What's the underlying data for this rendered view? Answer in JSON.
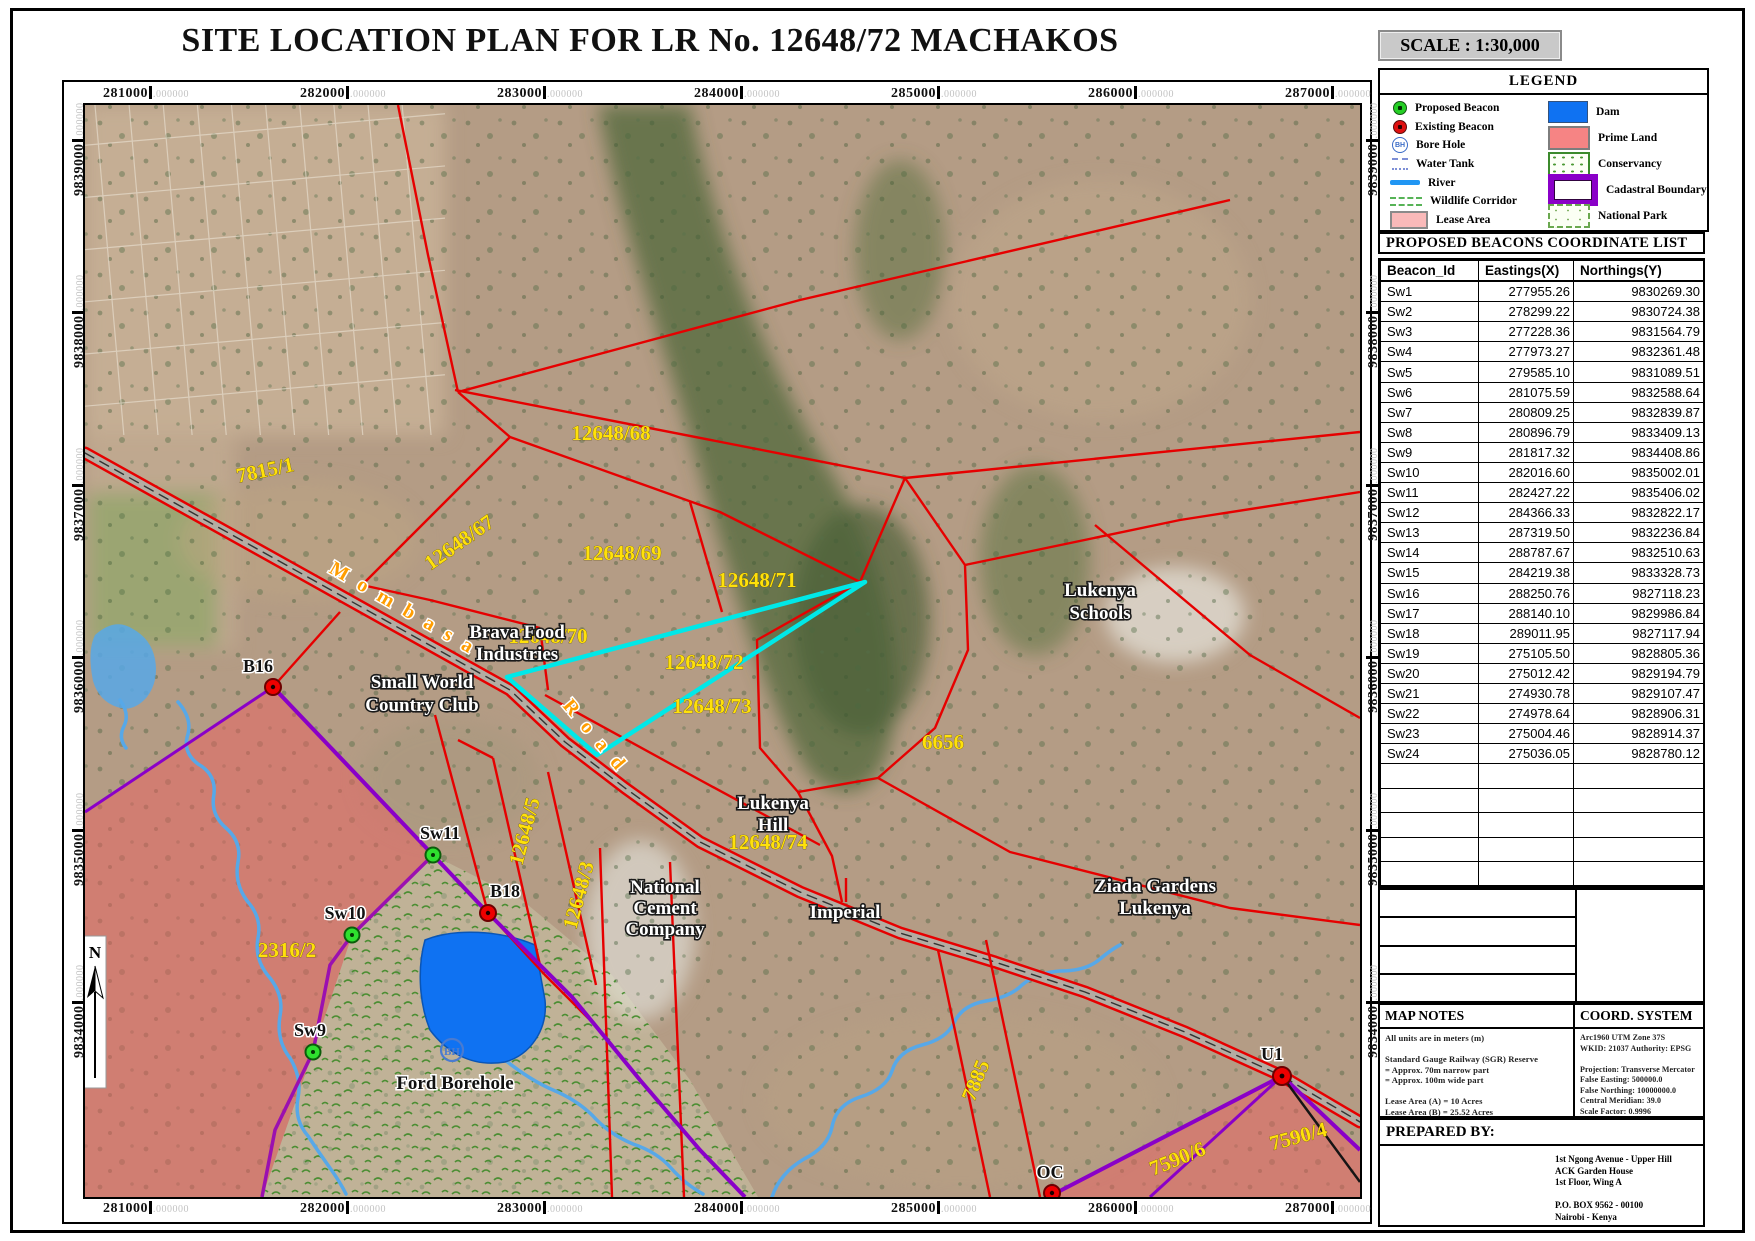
{
  "title": "SITE LOCATION PLAN FOR LR No. 12648/72 MACHAKOS",
  "scale_label": "SCALE : 1:30,000",
  "legend": {
    "title": "LEGEND",
    "items_left": [
      {
        "label": "Proposed Beacon"
      },
      {
        "label": "Existing Beacon"
      },
      {
        "label": "Bore Hole"
      },
      {
        "label": "Water Tank"
      },
      {
        "label": "River"
      },
      {
        "label": "Wildlife Corridor"
      },
      {
        "label": "Lease Area"
      }
    ],
    "items_right": [
      {
        "label": "Dam"
      },
      {
        "label": "Prime Land"
      },
      {
        "label": "Conservancy"
      },
      {
        "label": "Cadastral Boundary"
      },
      {
        "label": "National Park"
      }
    ]
  },
  "beacon_table": {
    "title": "PROPOSED BEACONS COORDINATE LIST",
    "columns": [
      "Beacon_Id",
      "Eastings(X)",
      "Northings(Y)"
    ],
    "rows": [
      {
        "id": "Sw1",
        "e": "277955.26",
        "n": "9830269.30"
      },
      {
        "id": "Sw2",
        "e": "278299.22",
        "n": "9830724.38"
      },
      {
        "id": "Sw3",
        "e": "277228.36",
        "n": "9831564.79"
      },
      {
        "id": "Sw4",
        "e": "277973.27",
        "n": "9832361.48"
      },
      {
        "id": "Sw5",
        "e": "279585.10",
        "n": "9831089.51"
      },
      {
        "id": "Sw6",
        "e": "281075.59",
        "n": "9832588.64"
      },
      {
        "id": "Sw7",
        "e": "280809.25",
        "n": "9832839.87"
      },
      {
        "id": "Sw8",
        "e": "280896.79",
        "n": "9833409.13"
      },
      {
        "id": "Sw9",
        "e": "281817.32",
        "n": "9834408.86"
      },
      {
        "id": "Sw10",
        "e": "282016.60",
        "n": "9835002.01"
      },
      {
        "id": "Sw11",
        "e": "282427.22",
        "n": "9835406.02"
      },
      {
        "id": "Sw12",
        "e": "284366.33",
        "n": "9832822.17"
      },
      {
        "id": "Sw13",
        "e": "287319.50",
        "n": "9832236.84"
      },
      {
        "id": "Sw14",
        "e": "288787.67",
        "n": "9832510.63"
      },
      {
        "id": "Sw15",
        "e": "284219.38",
        "n": "9833328.73"
      },
      {
        "id": "Sw16",
        "e": "288250.76",
        "n": "9827118.23"
      },
      {
        "id": "Sw17",
        "e": "288140.10",
        "n": "9829986.84"
      },
      {
        "id": "Sw18",
        "e": "289011.95",
        "n": "9827117.94"
      },
      {
        "id": "Sw19",
        "e": "275105.50",
        "n": "9828805.36"
      },
      {
        "id": "Sw20",
        "e": "275012.42",
        "n": "9829194.79"
      },
      {
        "id": "Sw21",
        "e": "274930.78",
        "n": "9829107.47"
      },
      {
        "id": "Sw22",
        "e": "274978.64",
        "n": "9828906.31"
      },
      {
        "id": "Sw23",
        "e": "275004.46",
        "n": "9828914.37"
      },
      {
        "id": "Sw24",
        "e": "275036.05",
        "n": "9828780.12"
      }
    ]
  },
  "axes": {
    "suffix": ".000000",
    "x": [
      "281000",
      "282000",
      "283000",
      "284000",
      "285000",
      "286000",
      "287000"
    ],
    "y": [
      "9839000",
      "9838000",
      "9837000",
      "9836000",
      "9835000",
      "9834000"
    ]
  },
  "map_notes": {
    "title": "MAP NOTES",
    "lines": [
      "All units are in meters (m)",
      "",
      "Standard Gauge Railway (SGR) Reserve",
      "= Approx. 70m narrow part",
      "= Approx. 100m wide part",
      "",
      "Lease Area (A) = 10 Acres",
      "Lease Area (B) = 25.52 Acres"
    ]
  },
  "coord_system": {
    "title": "COORD. SYSTEM",
    "lines": [
      "Arc1960 UTM Zone 37S",
      "WKID: 21037 Authority: EPSG",
      "",
      "Projection: Transverse Mercator",
      "False Easting: 500000.0",
      "False Northing: 10000000.0",
      "Central Meridian: 39.0",
      "Scale Factor: 0.9996",
      "Latitude Of Origin: 0.0",
      "Linear Unit: Meter (1.0)"
    ]
  },
  "prepared_by": {
    "title": "PREPARED BY:",
    "lines": [
      "1st Ngong Avenue - Upper Hill",
      "ACK Garden House",
      "1st Floor, Wing A",
      "",
      "P.O. BOX 9562 - 00100",
      "Nairobi - Kenya"
    ]
  },
  "map": {
    "parcel_labels": {
      "p7815": "7815/1",
      "p67": "12648/67",
      "p68": "12648/68",
      "p69": "12648/69",
      "p70": "12648/70",
      "p71": "12648/71",
      "p72": "12648/72",
      "p73": "12648/73",
      "p74": "12648/74",
      "p5": "12648/5",
      "p3": "12648/3",
      "p2316": "2316/2",
      "p6656": "6656",
      "p7885": "7885",
      "p7590_6": "7590/6",
      "p7590_4": "7590/4"
    },
    "place_labels": {
      "brava1": "Brava Food",
      "brava2": "Industries",
      "small1": "Small World",
      "small2": "Country Club",
      "schools1": "Lukenya",
      "schools2": "Schools",
      "hill1": "Lukenya",
      "hill2": "Hill",
      "cement1": "National",
      "cement2": "Cement",
      "cement3": "Company",
      "imperial": "Imperial",
      "ziada1": "Ziada Gardens",
      "ziada2": "Lukenya",
      "ford": "Ford Borehole"
    },
    "beacon_labels": {
      "b16": "B16",
      "b18": "B18",
      "u1": "U1",
      "oc": "OC",
      "sw9": "Sw9",
      "sw10": "Sw10",
      "sw11": "Sw11"
    },
    "road_labels": {
      "mombasa": "M o m b a s a",
      "road": "R o a d"
    },
    "borehole_symbol": "BH",
    "north": "N"
  },
  "colors": {
    "boundary_red": "#e60000",
    "cadastral_purple": "#8a00c8",
    "highlight_cyan": "#00e8e8",
    "dam_blue": "#0f72f2",
    "prime_land_pink": "#ec6060",
    "parcel_label_yellow": "#ffe10a"
  }
}
